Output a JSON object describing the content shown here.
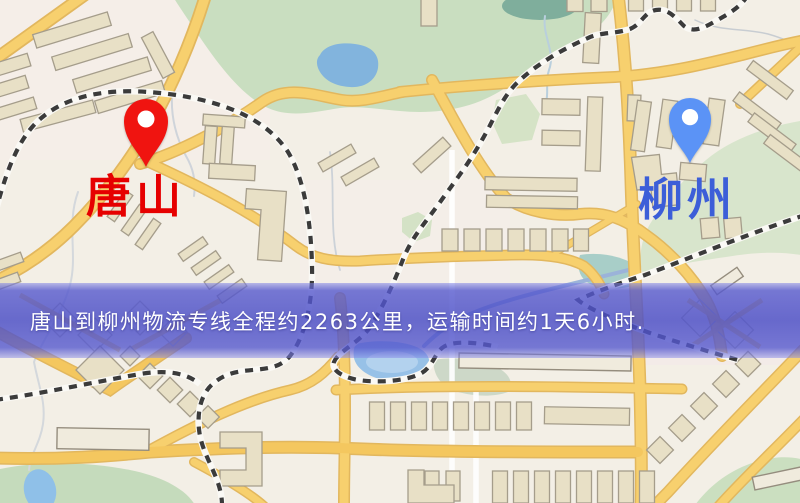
{
  "image_type": "logistics-route-map",
  "banner": {
    "text": "唐山到柳州物流专线全程约2263公里，运输时间约1天6小时.",
    "background_color": "#4b4ec6",
    "text_color": "#ffffff"
  },
  "markers": {
    "origin": {
      "name": "唐山",
      "pin_icon": "red-map-pin",
      "pin_color": "#f01410",
      "label_color": "#e60000"
    },
    "destination": {
      "name": "柳州",
      "pin_icon": "blue-map-pin",
      "pin_color": "#5b93f6",
      "label_color": "#3c5ed8"
    }
  },
  "route": {
    "distance_text": "约2263公里",
    "duration_text": "约1天6小时"
  },
  "map_palette": {
    "background": "#f3efe6",
    "road_major": "#f7d06e",
    "road_casing": "#e2b75e",
    "road_minor": "#ffffff",
    "park_green": "#c9dec0",
    "water_blue": "#8fc0e8",
    "building_fill": "#e8e0c6",
    "building_stroke": "#a59d8b",
    "railway_dark": "#3b3b3b"
  }
}
